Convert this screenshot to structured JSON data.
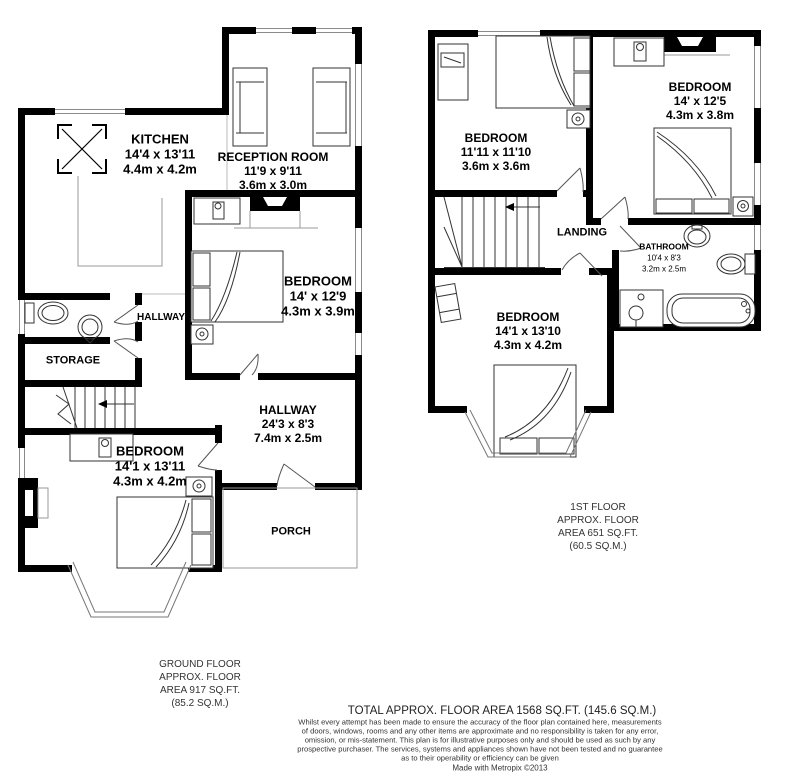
{
  "ground_floor": {
    "rooms": {
      "kitchen": {
        "name": "KITCHEN",
        "dims_ft": "14'4 x 13'11",
        "dims_m": "4.4m x 4.2m"
      },
      "reception": {
        "name": "RECEPTION ROOM",
        "dims_ft": "11'9 x 9'11",
        "dims_m": "3.6m x 3.0m"
      },
      "bedroom_rear": {
        "name": "BEDROOM",
        "dims_ft": "14' x 12'9",
        "dims_m": "4.3m x 3.9m"
      },
      "hallway_small": {
        "name": "HALLWAY"
      },
      "storage": {
        "name": "STORAGE"
      },
      "hallway_main": {
        "name": "HALLWAY",
        "dims_ft": "24'3 x 8'3",
        "dims_m": "7.4m x 2.5m"
      },
      "bedroom_front": {
        "name": "BEDROOM",
        "dims_ft": "14'1 x 13'11",
        "dims_m": "4.3m x 4.2m"
      },
      "porch": {
        "name": "PORCH"
      }
    },
    "caption": [
      "GROUND FLOOR",
      "APPROX. FLOOR",
      "AREA 917 SQ.FT.",
      "(85.2 SQ.M.)"
    ]
  },
  "first_floor": {
    "rooms": {
      "bedroom_left": {
        "name": "BEDROOM",
        "dims_ft": "11'11 x 11'10",
        "dims_m": "3.6m x 3.6m"
      },
      "bedroom_right": {
        "name": "BEDROOM",
        "dims_ft": "14' x 12'5",
        "dims_m": "4.3m x 3.8m"
      },
      "landing": {
        "name": "LANDING"
      },
      "bathroom": {
        "name": "BATHROOM",
        "dims_ft": "10'4 x 8'3",
        "dims_m": "3.2m x 2.5m"
      },
      "bedroom_front": {
        "name": "BEDROOM",
        "dims_ft": "14'1 x 13'10",
        "dims_m": "4.3m x 4.2m"
      }
    },
    "caption": [
      "1ST FLOOR",
      "APPROX. FLOOR",
      "AREA 651 SQ.FT.",
      "(60.5 SQ.M.)"
    ]
  },
  "footer": {
    "total": "TOTAL APPROX. FLOOR AREA 1568 SQ.FT. (145.6 SQ.M.)",
    "disclaimer": [
      "Whilst every attempt has been made to ensure the accuracy of the floor plan contained here, measurements",
      "of doors, windows, rooms and any other items are approximate and no responsibility is taken for any error,",
      "omission, or mis-statement. This plan is for illustrative purposes only and should be used as such by any",
      "prospective purchaser. The services, systems and appliances shown have not been tested and no guarantee",
      "as to their operability or efficiency can be given"
    ],
    "credit": "Made with Metropix ©2013"
  },
  "colors": {
    "wall": "#000000",
    "furniture_line": "#3a3a3a",
    "thin_line": "#9a9a9a",
    "text": "#000000",
    "muted_text": "#333333"
  }
}
